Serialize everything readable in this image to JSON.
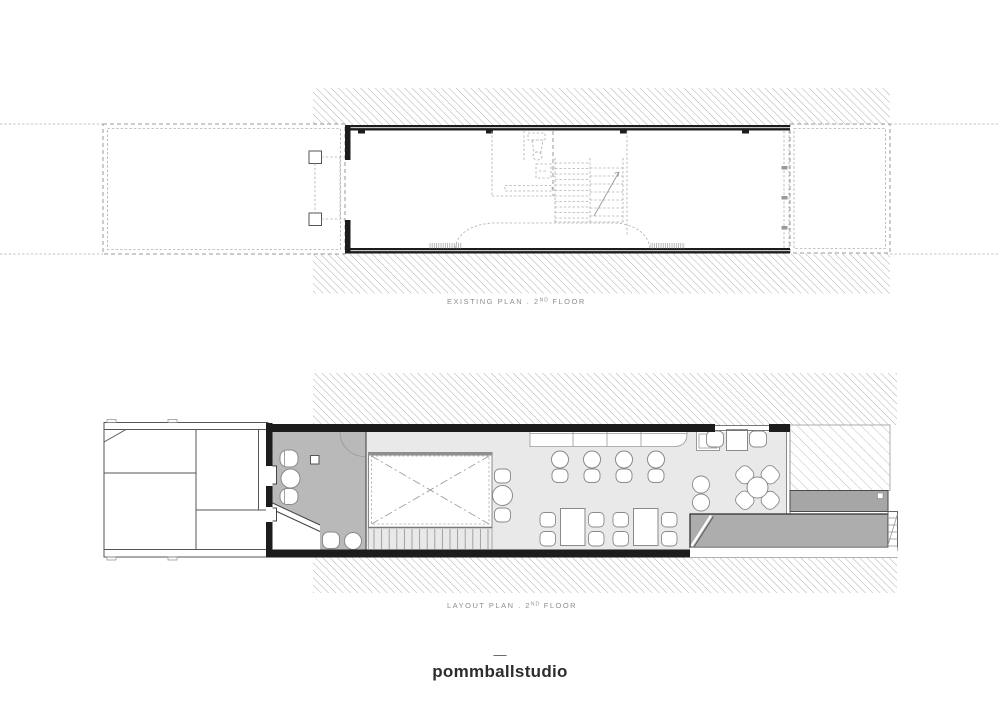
{
  "document": {
    "type": "architectural drawing sheet",
    "background": "#ffffff"
  },
  "plans": [
    {
      "id": "existing-plan-2nd-floor",
      "caption": {
        "prefix": "EXISTING PLAN . 2",
        "superscript": "ND",
        "suffix": " FLOOR"
      }
    },
    {
      "id": "layout-plan-2nd-floor",
      "caption": {
        "prefix": "LAYOUT PLAN . 2",
        "superscript": "ND",
        "suffix": " FLOOR"
      }
    }
  ],
  "footer": {
    "divider": "—",
    "brand": "pommballstudio"
  },
  "colors": {
    "hatch_line": "#9c9c9c",
    "deck_hatch_line": "#b8b8b8",
    "wall": "#1c1c1c",
    "dashed_line": "#9a9a9a",
    "light_line": "#b0b0b0",
    "bathroom_fill": "#b9b9b9",
    "floor_fill": "#e9e9e9",
    "ramp_fill": "#adadad",
    "planter_fill": "#a6a6a6",
    "furniture_stroke": "#8a8a8a",
    "caption_text": "#8e8e8e",
    "brand_text": "#2d2d2d"
  }
}
